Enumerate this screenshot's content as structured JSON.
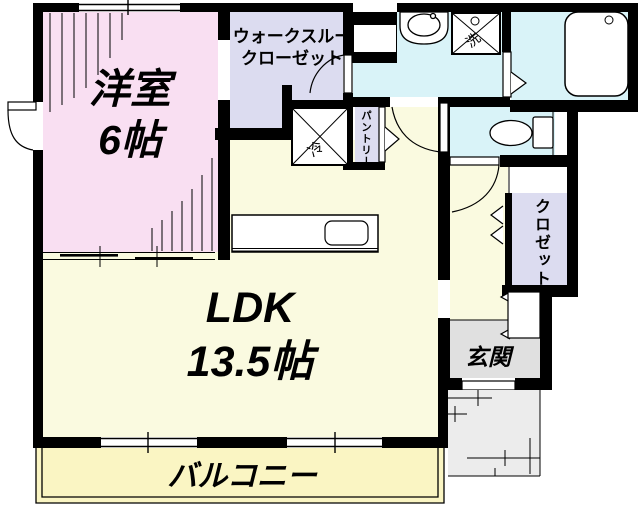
{
  "rooms": {
    "western_room": {
      "name": "洋室",
      "size": "6帖"
    },
    "walk_through_closet": {
      "name_line1": "ウォークスルー",
      "name_line2": "クローゼット"
    },
    "ldk": {
      "name": "LDK",
      "size": "13.5帖"
    },
    "balcony": {
      "name": "バルコニー"
    },
    "entrance": {
      "name": "玄関"
    },
    "closet": {
      "name": "クロゼット"
    },
    "pantry": {
      "name": "パントリー"
    }
  },
  "fixtures": {
    "refrigerator": {
      "label": "冷"
    },
    "washer": {
      "label": "洗"
    }
  },
  "colors": {
    "western_room": "#f9dff2",
    "closet_lavender": "#dcdcf0",
    "ldk_yellow": "#fafae0",
    "balcony_yellow": "#faf5c3",
    "water_cyan": "#d9f3f8",
    "entrance_gray": "#e0e0e0",
    "porch_gray": "#ececec",
    "wall": "#000000"
  }
}
